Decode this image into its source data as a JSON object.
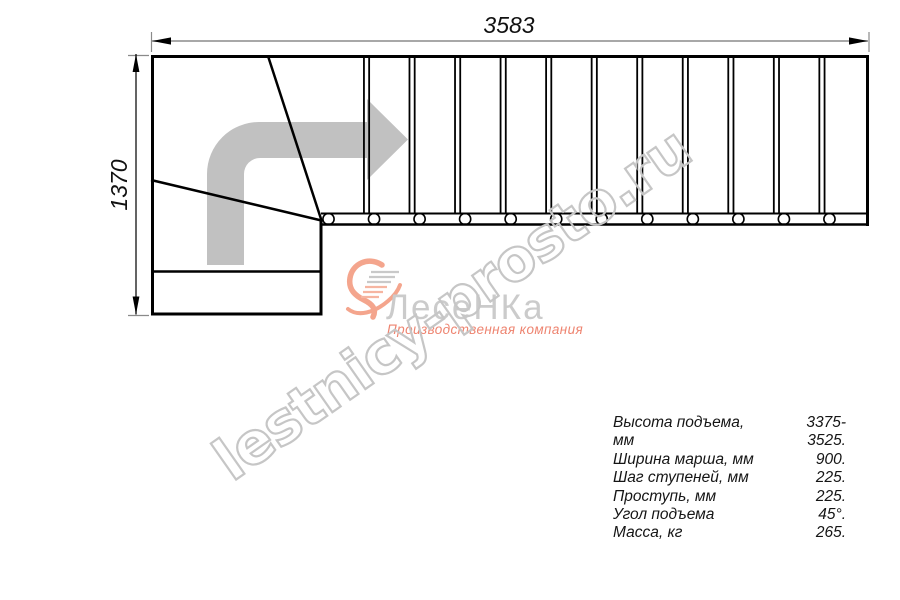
{
  "drawing": {
    "dimension_top_mm": "3583",
    "dimension_left_mm": "1370",
    "steps_count": 12,
    "direction_arrow": "up-then-right"
  },
  "specs": {
    "rows": [
      {
        "label": "Высота подъема, мм",
        "value": "3375-3525."
      },
      {
        "label": "Ширина марша, мм",
        "value": "900."
      },
      {
        "label": "Шаг ступеней, мм",
        "value": "225."
      },
      {
        "label": "Проступь, мм",
        "value": "225."
      },
      {
        "label": "Угол подъема",
        "value": "45°."
      },
      {
        "label": "Масса, кг",
        "value": "265."
      }
    ]
  },
  "branding": {
    "logo_text": "ЛесеНКа",
    "logo_subtitle": "Производственная компания",
    "watermark_text": "lestnicy-prosto.ru",
    "accent_color": "#f4a58d",
    "accent_dark_color": "#ee8470",
    "logo_text_color": "#cbcbcb",
    "watermark_color": "#c6c6c6",
    "drawing_arrow_color": "#c1c1c1"
  }
}
